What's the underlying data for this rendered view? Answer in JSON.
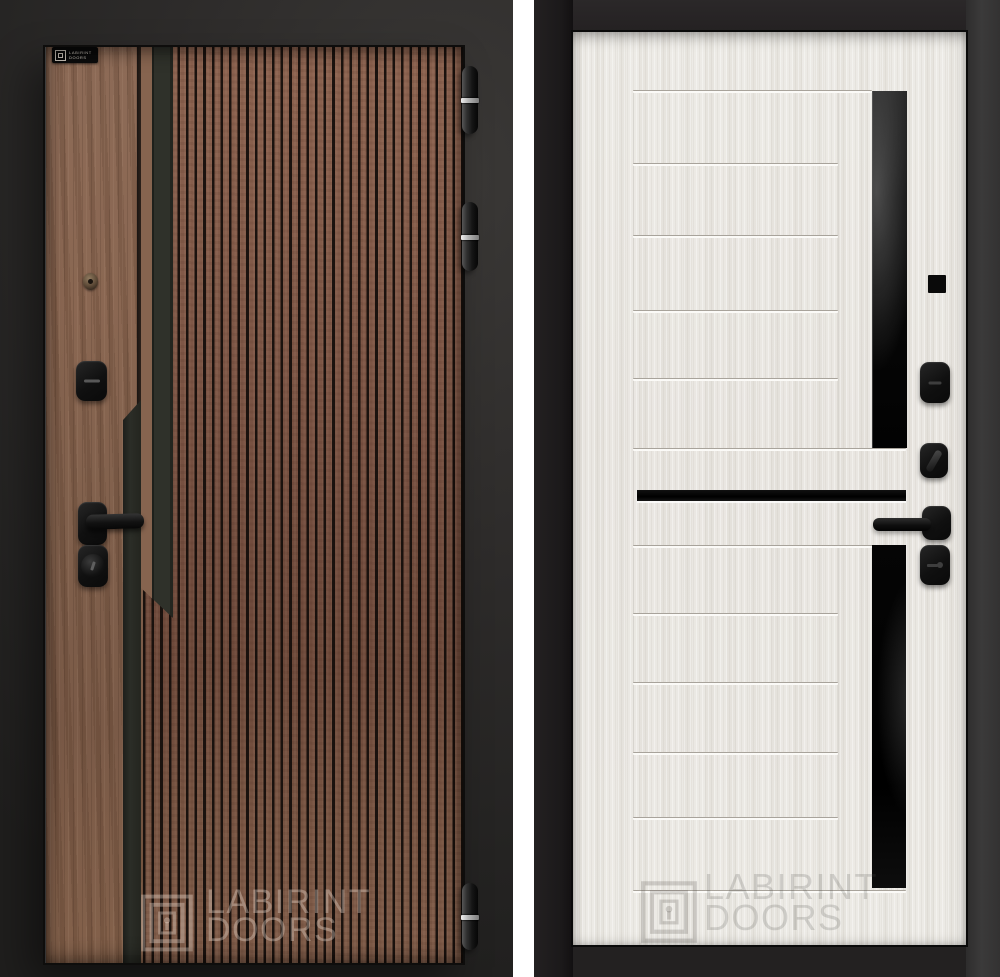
{
  "scene": {
    "description": "Product photo of a LABIRINT entry door: exterior side with dark fluted wood finish (left) and interior side in white sandal wood with black glass inserts (right)",
    "brand": "LABIRINT DOORS"
  },
  "left_door": {
    "brand_plate": {
      "line1": "LABIRINT",
      "line2": "DOORS"
    },
    "watermark": {
      "line1": "LABIRINT",
      "line2": "DOORS"
    },
    "colors": {
      "background": "#2e2c2a",
      "frame": "#1c1b1a",
      "smooth_wood": "#87664f",
      "fluted_wood": "#7d5a49",
      "flute_gap": "#261e19",
      "accent_strip": "#2d2f28",
      "hardware": "#141414",
      "hinge_band": "#c9c9c9"
    },
    "hinge_count": 3
  },
  "right_door": {
    "watermark": {
      "line1": "LABIRINT",
      "line2": "DOORS"
    },
    "colors": {
      "panel": "#eae7e2",
      "frame": "#262424",
      "frame_right": "#3a3a3a",
      "glass": "#070707",
      "hardware": "#101010"
    },
    "groove_count": 12
  }
}
